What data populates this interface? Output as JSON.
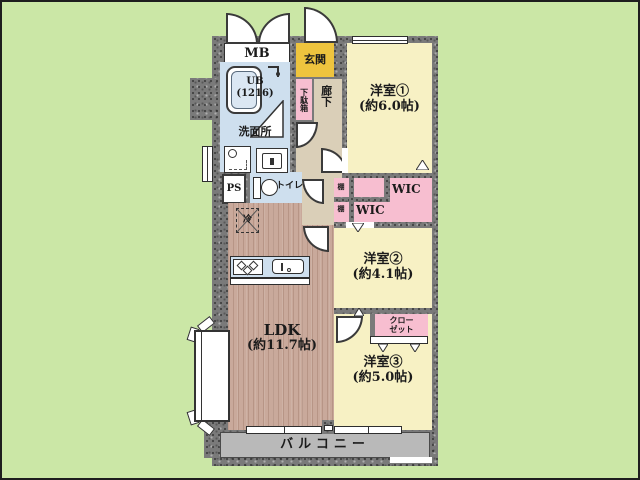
{
  "floor_plan": {
    "meter_box": {
      "label": "MB"
    },
    "entrance": {
      "label": "玄関"
    },
    "shoe_box": {
      "label": "下駄箱"
    },
    "hallway": {
      "label": "廊下"
    },
    "unit_bath": {
      "line1": "UB",
      "line2": "(1216)"
    },
    "washroom": {
      "label": "洗面所"
    },
    "pipe_space": {
      "label": "PS"
    },
    "toilet": {
      "label": "トイレ"
    },
    "western_room_1": {
      "line1": "洋室①",
      "line2": "(約6.0帖)"
    },
    "western_room_2": {
      "line1": "洋室②",
      "line2": "(約4.1帖)"
    },
    "western_room_3": {
      "line1": "洋室③",
      "line2": "(約5.0帖)"
    },
    "wic_upper": {
      "label": "WIC"
    },
    "wic_lower": {
      "label": "WIC"
    },
    "shelf_upper": {
      "label": "棚"
    },
    "shelf_lower": {
      "label": "棚"
    },
    "closet": {
      "line1": "クロー",
      "line2": "ゼット"
    },
    "ldk": {
      "line1": "LDK",
      "line2": "(約11.7帖)"
    },
    "balcony": {
      "label": "バルコニー"
    },
    "refrigerator": {
      "label": "冷"
    }
  },
  "colors": {
    "background_green": "#cbe7a6",
    "wall_gray": "#7a7a7a",
    "room_yellow": "#f7f1c4",
    "entrance_gold": "#eec43e",
    "corridor_beige": "#dacfb8",
    "wet_area_blue": "#cedfee",
    "storage_pink": "#f7bed0",
    "ldk_wood_brown": "#c9a99b",
    "balcony_gray": "#b9b9b9",
    "line_black": "#2e2e2e"
  }
}
